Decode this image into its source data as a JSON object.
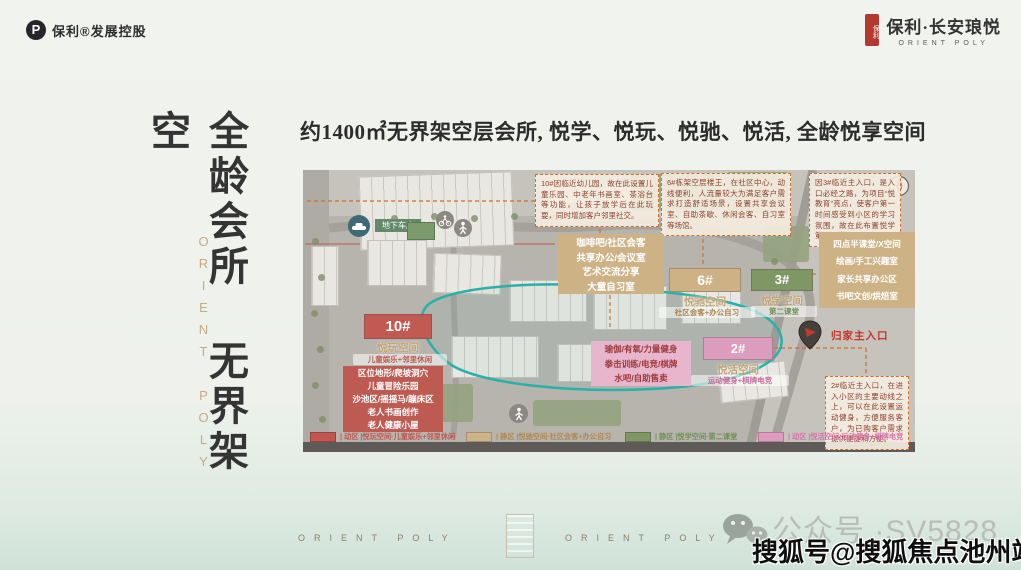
{
  "header": {
    "logo_text": "保利®发展控股",
    "logo_mark": "P",
    "seal_text": "保利",
    "brand_name": "保利·长安琅悦",
    "brand_sub": "ORIENT POLY"
  },
  "left_panel": {
    "vertical_title": "全龄会所 无界架空",
    "vertical_brand": "ORIENT POLY"
  },
  "main_title": "约1400㎡无界架空层会所, 悦学、悦玩、悦驰、悦活, 全龄悦享空间",
  "map": {
    "labels": {
      "garage": "地下车库",
      "entrance": "归家主入口"
    },
    "notes": {
      "n10": "10#因临近幼儿园，故在此设置儿童乐园、中老年书画室、茶浴台等功能，让孩子放学后在此玩耍，同时增加客户邻里社交。",
      "n6": "6#栋架空层楼王，在社区中心，动线便利，人流量较大为满足客户需求打造舒适场景，设置共享会议室、自助茶歇、休闲会客、自习室等场馆。",
      "n3": "因3#临近主入口，是入口必经之路，为项目“悦教育”亮点，使客户第一时间感受到小区的学习氛围，故在此布置悦学第二课堂",
      "n2": "2#临近主入口，在进入小区的主要动线之上，可以在此设置运动健身，方便服务客户，为已购客户需求提供便捷和方便。"
    },
    "buildings": {
      "b10": {
        "num": "10#",
        "space": "悦玩空间",
        "desc": "儿童娱乐+邻里休闲"
      },
      "b6": {
        "num": "6#",
        "space": "悦驰空间",
        "desc": "社区会客+办公自习"
      },
      "b3": {
        "num": "3#",
        "space": "悦学空间",
        "desc": "第二课堂"
      },
      "b2": {
        "num": "2#",
        "space": "悦活空间",
        "desc": "运动健身+棋牌电竞"
      }
    },
    "amenities": {
      "cafe": [
        "咖啡吧/社区会客",
        "共享办公/会议室",
        "艺术交流分享",
        "大童自习室"
      ],
      "study": [
        "四点半课堂/X空间",
        "绘画/手工兴趣室",
        "家长共享办公区",
        "书吧文创/烘焙室"
      ],
      "play": [
        "区位地形/爬坡洞穴",
        "儿童冒险乐园",
        "沙池区/摇摇马/蹦床区",
        "老人书画创作",
        "老人健康小屋"
      ],
      "gym": [
        "瑜伽/有氧/力量健身",
        "拳击训练/电竞/棋牌",
        "水吧/自助售卖"
      ]
    },
    "legend": [
      {
        "color": "#c0564f",
        "text": "| 动区 |悦玩空间·儿童娱乐+邻里休闲"
      },
      {
        "color": "#cdb488",
        "text": "| 静区 |悦驰空间·社区会客+办公自习"
      },
      {
        "color": "#7f9765",
        "text": "| 静区 |悦学空间·第二课堂"
      },
      {
        "color": "#df9cbe",
        "text": "| 动区 |悦活空间·运动健身+棋牌电竞"
      }
    ],
    "colors": {
      "zone_red": "#c0564f",
      "zone_tan": "#cdb286",
      "zone_green": "#7f9765",
      "zone_pink": "#dc9cbe",
      "loop_teal": "#2bb0a8",
      "note_border": "#cf6d2b"
    }
  },
  "footer": {
    "brand_left": "ORIENT POLY",
    "brand_right": "ORIENT POLY",
    "wechat_text": "公众号 ·SV5828",
    "watermark": "搜狐号@搜狐焦点池州站"
  }
}
